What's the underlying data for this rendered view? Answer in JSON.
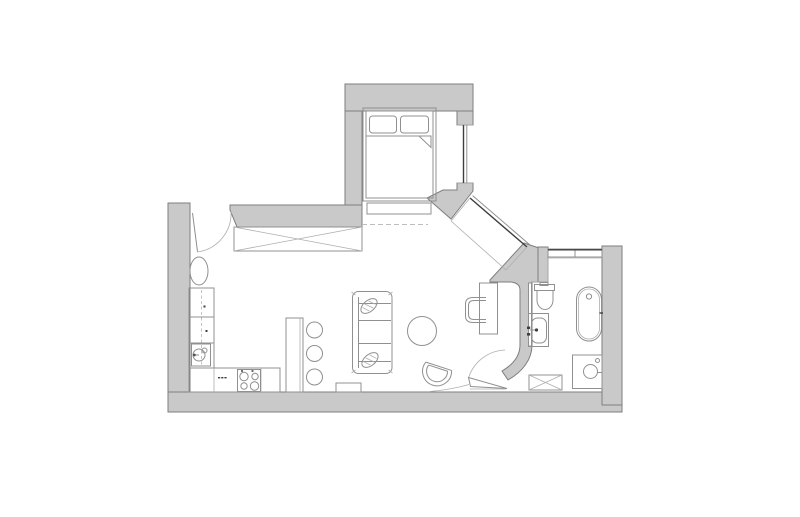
{
  "canvas": {
    "width": 800,
    "height": 517,
    "background": "#ffffff"
  },
  "palette": {
    "floor": "#ffffff",
    "wall_fill": "#c9c9ca",
    "wall_stroke": "#7e7e7e",
    "furniture_stroke": "#909090",
    "light_stroke": "#aeaeae",
    "dark_detail": "#3f3f3f",
    "dashed_line": "#bdbdbd"
  },
  "plan": {
    "title": "studio-apartment-floor-plan",
    "rooms": [
      {
        "id": "entry",
        "label": "entry"
      },
      {
        "id": "living-kitchen",
        "label": "living area with open kitchen"
      },
      {
        "id": "sleeping-nook",
        "label": "sleeping nook"
      },
      {
        "id": "bathroom",
        "label": "bathroom"
      }
    ],
    "furniture": [
      "entry-door",
      "oval-mirror",
      "wardrobe",
      "double-bed",
      "pillows",
      "blanket-fold",
      "bed-bench",
      "kitchen-counter",
      "kitchen-sink",
      "stove",
      "bar-counter",
      "bar-stools",
      "sofa",
      "sofa-cushions",
      "side-table",
      "coffee-table",
      "armchair",
      "desk",
      "desk-chair",
      "toilet",
      "bathroom-sink",
      "bathtub",
      "shower-unit",
      "washing-machine",
      "bathroom-door",
      "bedroom-window",
      "diagonal-window",
      "bathroom-window"
    ]
  }
}
